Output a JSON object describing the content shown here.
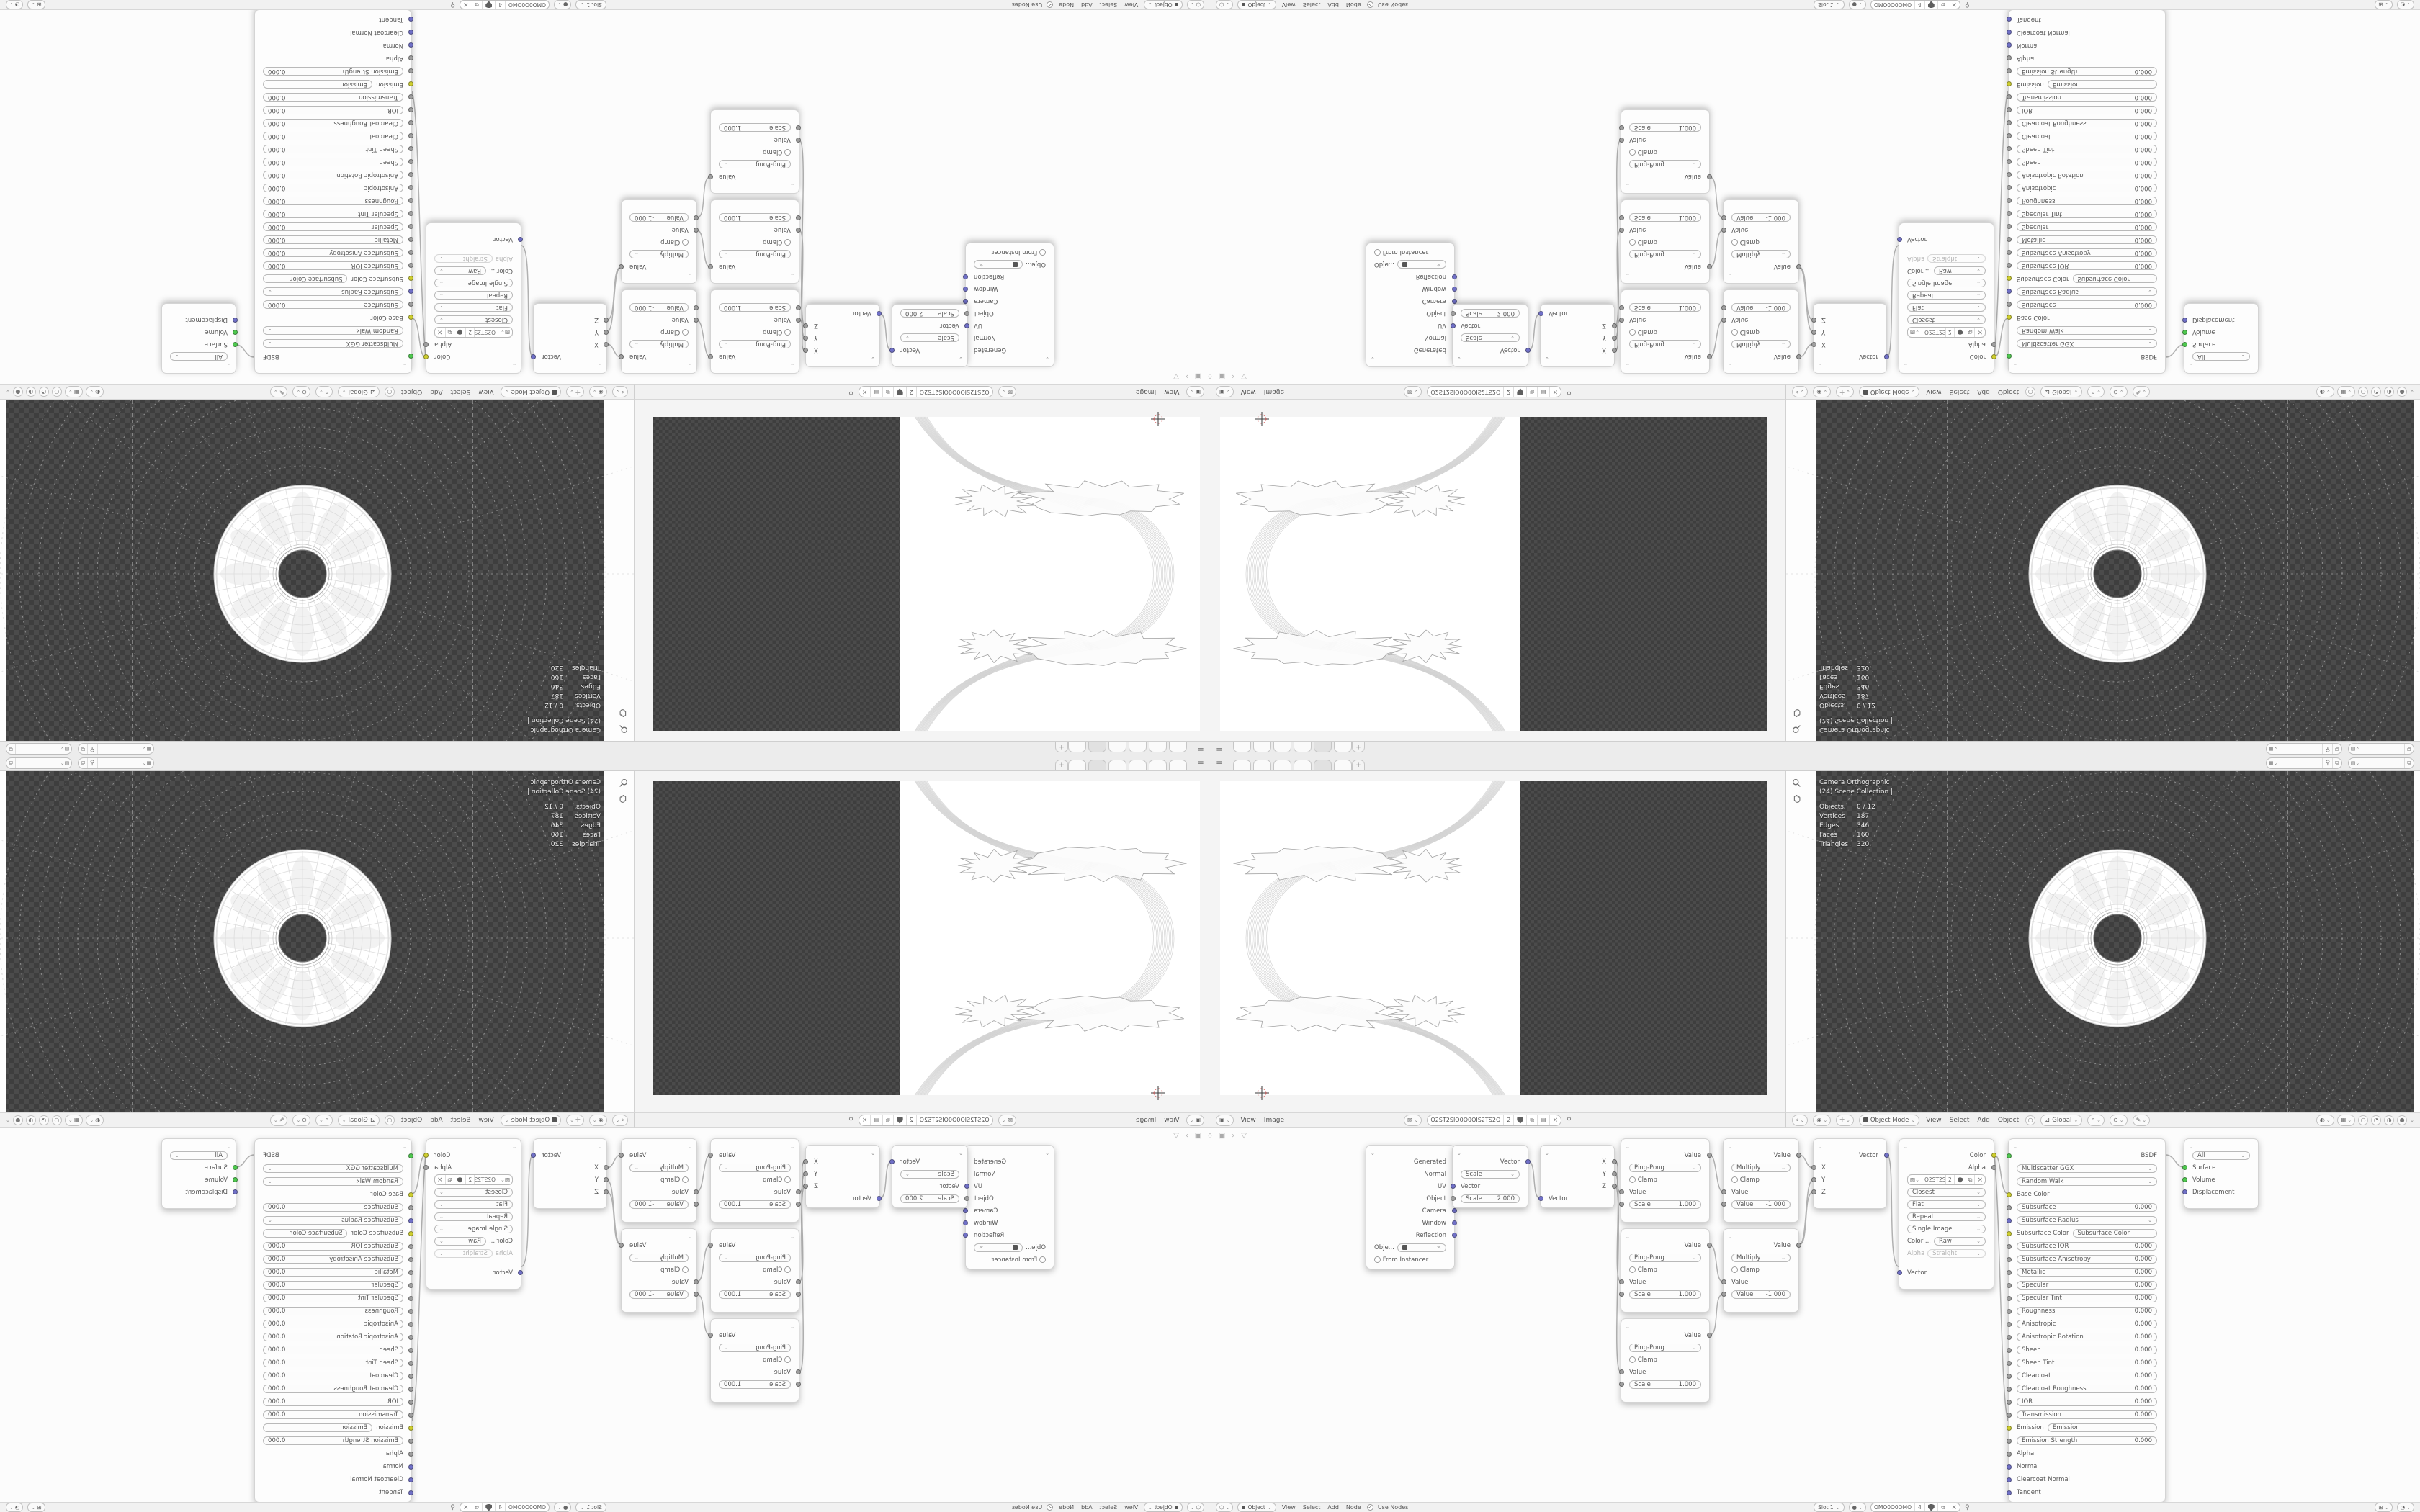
{
  "colors": {
    "accent_vector": "#7070c8",
    "accent_value": "#9f9f9f",
    "accent_color": "#cfcf2e",
    "accent_shader": "#4ec94e",
    "checker_dark": "#3e3e3e",
    "checker_light": "#4b4b4b"
  },
  "icons": {
    "hamburger": "menu",
    "plus": "new-workspace",
    "pin": "pin",
    "copy": "copy",
    "pack": "pack",
    "close": "unlink",
    "shield": "fake-user",
    "caret": "dropdown",
    "eyedropper": "pick-object",
    "magnifier": "zoom",
    "hand": "pan",
    "crosshair": "cursor-2d"
  },
  "topbar": {
    "tabs": [
      "",
      "",
      "",
      "",
      "active",
      ""
    ],
    "new_tab_label": "+",
    "scene_value": "",
    "view_layer_value": ""
  },
  "image_editor": {
    "header": {
      "menus": [
        "View",
        "Image"
      ],
      "datablock": {
        "name": "O2ST2SIO0O0OIS2TS2O",
        "users": "2"
      }
    }
  },
  "viewport": {
    "overlay": {
      "view_name": "Camera Orthographic",
      "collection": "(24) Scene Collection |",
      "stats": [
        {
          "label": "Objects",
          "value": "0 / 12"
        },
        {
          "label": "Vertices",
          "value": "187"
        },
        {
          "label": "Edges",
          "value": "346"
        },
        {
          "label": "Faces",
          "value": "160"
        },
        {
          "label": "Triangles",
          "value": "320"
        }
      ]
    },
    "header": {
      "mode": "Object Mode",
      "menus": [
        "View",
        "Select",
        "Add",
        "Object"
      ],
      "orientation": "Global"
    }
  },
  "shader_header": {
    "shader_type": "Object",
    "menus": [
      "View",
      "Select",
      "Add",
      "Node"
    ],
    "use_nodes": "Use Nodes",
    "slot": "Slot 1",
    "material": {
      "name": "OMO0O0OMO",
      "users": "4"
    }
  },
  "node_editor": {
    "nodes": {
      "texture_coordinate": {
        "outputs": [
          "Generated",
          "Normal",
          "UV",
          "Object",
          "Camera",
          "Window",
          "Reflection"
        ],
        "object_label": "Obje...",
        "from_instancer": "From Instancer"
      },
      "vector_math": {
        "output": "Vector",
        "operation": "Scale",
        "input": "Vector",
        "scale_label": "Scale",
        "scale_value": "2.000"
      },
      "separate_xyz": {
        "outputs": [
          "X",
          "Y",
          "Z"
        ],
        "input": "Vector"
      },
      "math_pingpong": {
        "output": "Value",
        "operation": "Ping-Pong",
        "clamp": "Clamp",
        "input": "Value",
        "arg_label": "Scale",
        "arg_value": "1.000"
      },
      "math_multiply": {
        "output": "Value",
        "operation": "Multiply",
        "clamp": "Clamp",
        "input": "Value",
        "arg_label": "Value",
        "arg_value": "-1.000"
      },
      "combine_xyz": {
        "output": "Vector",
        "inputs": [
          "X",
          "Y",
          "Z"
        ]
      },
      "image_texture": {
        "outputs_color": "Color",
        "outputs_alpha": "Alpha",
        "users": "2",
        "interpolation": "Closest",
        "projection": "Flat",
        "extension": "Repeat",
        "source": "Single Image",
        "colorspace_label": "Color ...",
        "colorspace_value": "Raw",
        "alpha_label": "Alpha",
        "alpha_value": "Straight",
        "input": "Vector"
      },
      "principled": {
        "rows": [
          {
            "type": "out",
            "socket": "shader",
            "label": "BSDF"
          },
          {
            "type": "menu",
            "socket": "none",
            "label": "Multiscatter GGX"
          },
          {
            "type": "menu",
            "socket": "none",
            "label": "Random Walk"
          },
          {
            "type": "socket",
            "socket": "color",
            "label": "Base Color"
          },
          {
            "type": "slider",
            "socket": "value",
            "label": "Subsurface",
            "value": "0.000"
          },
          {
            "type": "menu",
            "socket": "vector",
            "label": "Subsurface Radius"
          },
          {
            "type": "field",
            "socket": "color",
            "label": "Subsurface Color"
          },
          {
            "type": "slider",
            "socket": "value",
            "label": "Subsurface IOR",
            "value": "0.000"
          },
          {
            "type": "slider",
            "socket": "value",
            "label": "Subsurface Anisotropy",
            "value": "0.000"
          },
          {
            "type": "slider",
            "socket": "value",
            "label": "Metallic",
            "value": "0.000"
          },
          {
            "type": "slider",
            "socket": "value",
            "label": "Specular",
            "value": "0.000"
          },
          {
            "type": "slider",
            "socket": "value",
            "label": "Specular Tint",
            "value": "0.000"
          },
          {
            "type": "slider",
            "socket": "value",
            "label": "Roughness",
            "value": "0.000"
          },
          {
            "type": "slider",
            "socket": "value",
            "label": "Anisotropic",
            "value": "0.000"
          },
          {
            "type": "slider",
            "socket": "value",
            "label": "Anisotropic Rotation",
            "value": "0.000"
          },
          {
            "type": "slider",
            "socket": "value",
            "label": "Sheen",
            "value": "0.000"
          },
          {
            "type": "slider",
            "socket": "value",
            "label": "Sheen Tint",
            "value": "0.000"
          },
          {
            "type": "slider",
            "socket": "value",
            "label": "Clearcoat",
            "value": "0.000"
          },
          {
            "type": "slider",
            "socket": "value",
            "label": "Clearcoat Roughness",
            "value": "0.000"
          },
          {
            "type": "slider",
            "socket": "value",
            "label": "IOR",
            "value": "0.000"
          },
          {
            "type": "slider",
            "socket": "value",
            "label": "Transmission",
            "value": "0.000"
          },
          {
            "type": "field",
            "socket": "color",
            "label": "Emission"
          },
          {
            "type": "slider",
            "socket": "value",
            "label": "Emission Strength",
            "value": "0.000"
          },
          {
            "type": "socket",
            "socket": "value",
            "label": "Alpha"
          },
          {
            "type": "socket",
            "socket": "vector",
            "label": "Normal"
          },
          {
            "type": "socket",
            "socket": "vector",
            "label": "Clearcoat Normal"
          },
          {
            "type": "socket",
            "socket": "vector",
            "label": "Tangent"
          }
        ]
      },
      "material_output": {
        "target": "All",
        "inputs_surface": "Surface",
        "inputs_volume": "Volume",
        "inputs_displacement": "Displacement"
      }
    }
  }
}
